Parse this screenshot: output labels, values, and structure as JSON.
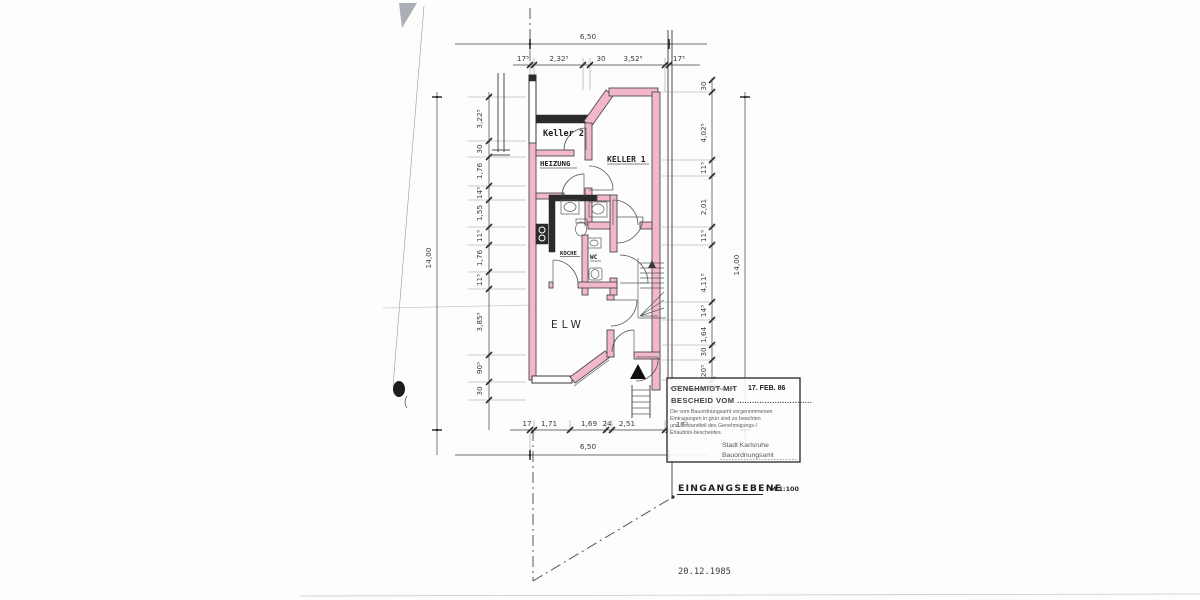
{
  "document": {
    "plan_title": "EINGANGSEBENE",
    "scale": "M 1:100",
    "date": "20.12.1985"
  },
  "rooms": {
    "keller2": "Keller 2",
    "heizung": "HEIZUNG",
    "keller1": "KELLER 1",
    "kueche": "KOCHE",
    "wc": "WC",
    "elw": "ELW"
  },
  "stamp": {
    "line1": "GENEHMIGT MIT",
    "date": "17. FEB. 86",
    "line2": "BESCHEID VOM ..............................",
    "body1": "Die vom Bauordnungsamt vorgenommenen",
    "body2": "Eintragungen in grün sind zu beachten",
    "body3": "und Bestandteil des Genehmigungs-/",
    "body4": "Erlaubnis-bescheides.",
    "authority1": "Stadt Karlsruhe",
    "authority2": "Bauordnungsamt"
  },
  "dimensions": {
    "top_total": "6,50",
    "bottom_total": "6,50",
    "left_total": "14,00",
    "right_total": "14,00",
    "top_chain": [
      "17⁵",
      "2,32⁵",
      "30",
      "3,52⁵",
      "17⁵"
    ],
    "bottom_chain": [
      "17",
      "1,71",
      "1,69",
      "24",
      "2,51",
      "17⁵"
    ],
    "left_chain": [
      "3,22⁵",
      "30",
      "1,76",
      "14⁵",
      "1,55",
      "11⁵",
      "1,76",
      "11⁵",
      "3,85⁵",
      "90⁵",
      "30"
    ],
    "right_chain": [
      "30",
      "4,02⁵",
      "11⁵",
      "2,01",
      "11⁵",
      "4,11⁵",
      "14⁵",
      "1,64",
      "30",
      "20⁵"
    ]
  },
  "colors": {
    "wall_highlight": "#f2b7ca",
    "ink": "#3a3a3a",
    "paper": "#fdfdfc"
  }
}
